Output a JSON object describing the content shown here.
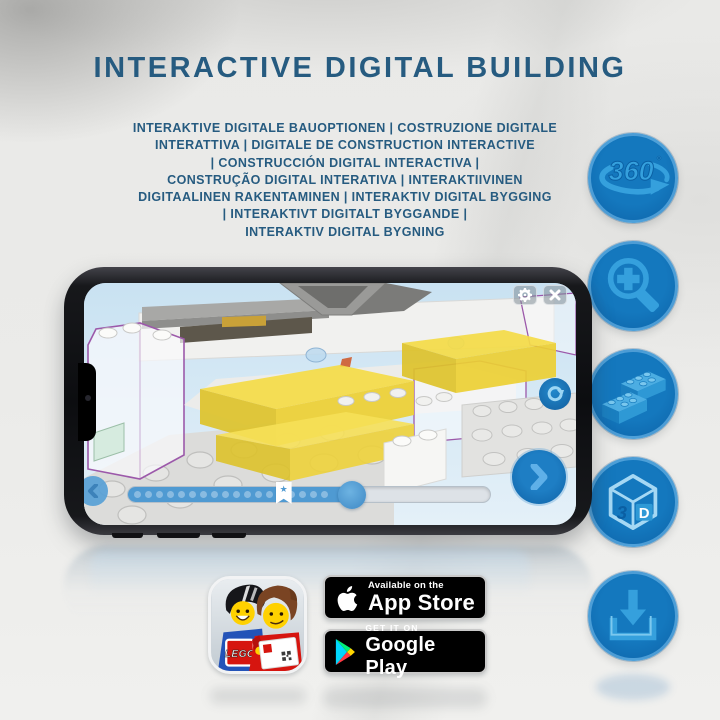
{
  "poster": {
    "title": "INTERACTIVE DIGITAL BUILDING",
    "subtitle_lines": [
      "INTERAKTIVE DIGITALE BAUOPTIONEN | COSTRUZIONE DIGITALE",
      "INTERATTIVA | DIGITALE DE CONSTRUCTION INTERACTIVE",
      "| CONSTRUCCIÓN DIGITAL INTERACTIVA |",
      "CONSTRUÇÃO DIGITAL INTERATIVA | INTERAKTIIVINEN",
      "DIGITAALINEN RAKENTAMINEN | INTERAKTIV DIGITAL BYGGING",
      "| INTERAKTIVT DIGITALT BYGGANDE |",
      "INTERAKTIV DIGITAL BYGNING"
    ]
  },
  "features": {
    "icons": [
      "360-rotation",
      "zoom-in",
      "building-bricks",
      "3d-view",
      "download"
    ],
    "rotation": {
      "number": "360",
      "degree": "°"
    },
    "cube": {
      "digit": "3",
      "letter": "D"
    }
  },
  "phone": {
    "controls": {
      "marker_star": "★"
    },
    "progress": {
      "fill_percent": 62,
      "marker_percent": 43,
      "dot_count": 18
    }
  },
  "badges": {
    "app_store": {
      "tagline": "Available on the",
      "store_name": "App Store"
    },
    "google_play": {
      "tagline": "GET IT ON",
      "store_name": "Google Play"
    },
    "lego_app": {
      "logo_text": "LEGO"
    }
  },
  "colors": {
    "heading_blue": "#265b80",
    "circle_blue": "#0e6cb4",
    "icon_light_blue": "#35a0dd",
    "screen_sky": "#cfe4f2",
    "progress_blue": "#4f9ad2",
    "lego_yellow": "#f2d945",
    "lego_red": "#d6150f"
  }
}
